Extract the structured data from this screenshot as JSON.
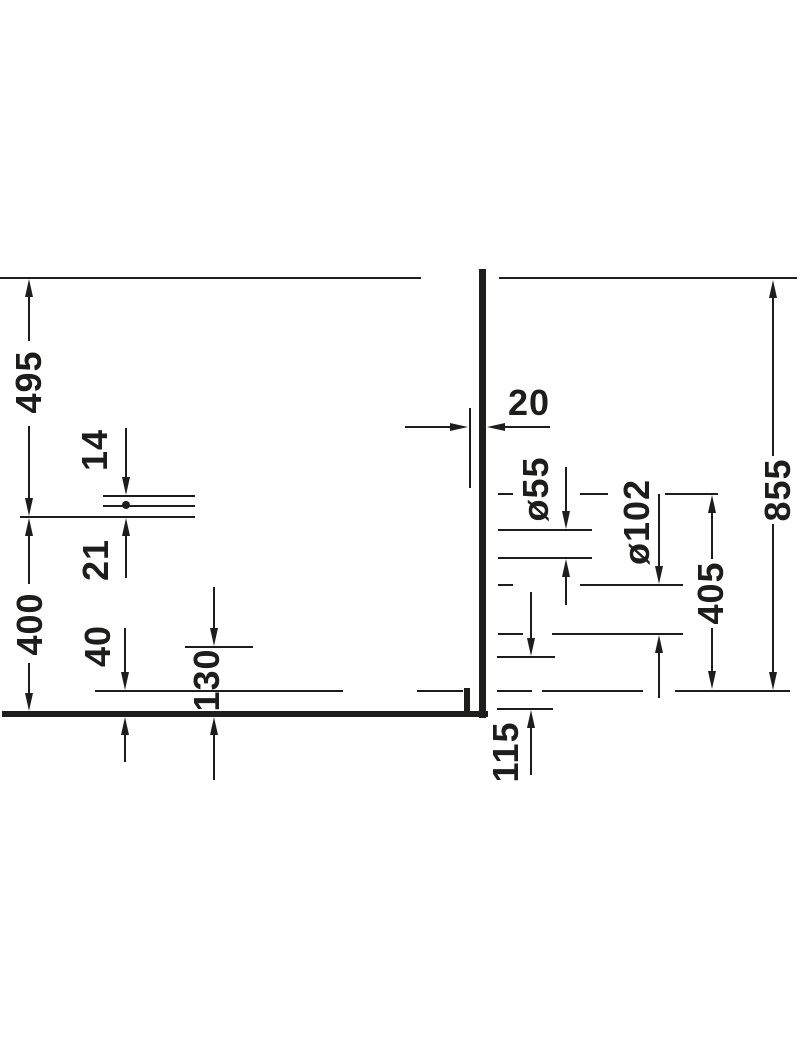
{
  "drawing": {
    "type": "technical-dimension-drawing",
    "background_color": "#ffffff",
    "line_color": "#1d1d1b",
    "dimensions": [
      {
        "label": "495",
        "orientation": "vertical"
      },
      {
        "label": "400",
        "orientation": "vertical"
      },
      {
        "label": "14",
        "orientation": "vertical"
      },
      {
        "label": "21",
        "orientation": "vertical"
      },
      {
        "label": "40",
        "orientation": "vertical"
      },
      {
        "label": "130",
        "orientation": "vertical"
      },
      {
        "label": "20",
        "orientation": "horizontal"
      },
      {
        "label": "ø55",
        "orientation": "vertical"
      },
      {
        "label": "ø102",
        "orientation": "vertical"
      },
      {
        "label": "405",
        "orientation": "vertical"
      },
      {
        "label": "855",
        "orientation": "vertical"
      },
      {
        "label": "115",
        "orientation": "vertical"
      }
    ]
  }
}
